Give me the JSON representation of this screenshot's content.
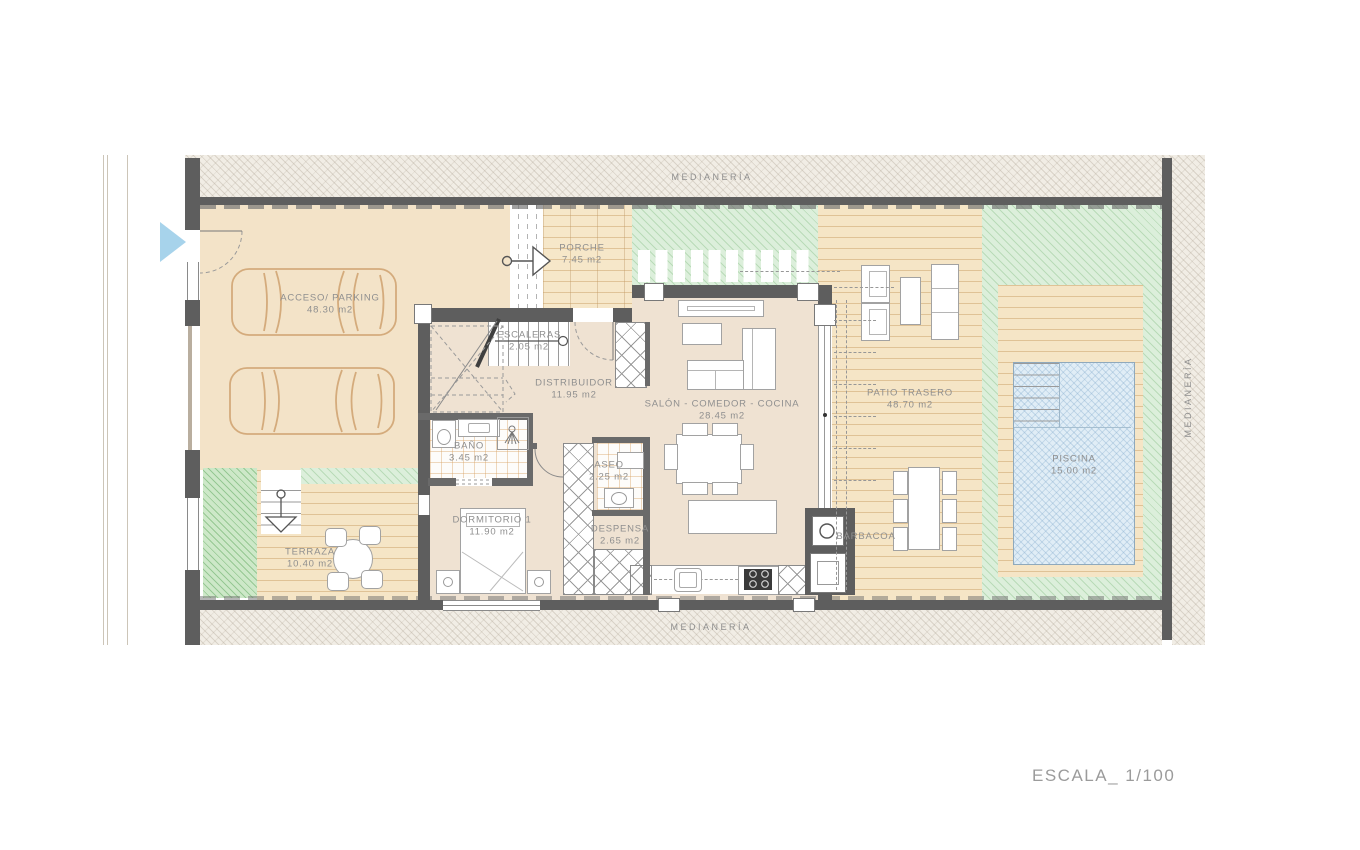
{
  "plan": {
    "scale_label": "ESCALA_ 1/100",
    "boundaries": {
      "top": "MEDIANERÍA",
      "bottom": "MEDIANERÍA",
      "right": "MEDIANERÍA"
    },
    "rooms": [
      {
        "name": "ACCESO/ PARKING",
        "area": "48.30 m2"
      },
      {
        "name": "PORCHE",
        "area": "7.45 m2"
      },
      {
        "name": "ESCALERAS",
        "area": "2.05 m2"
      },
      {
        "name": "DISTRIBUIDOR",
        "area": "11.95 m2"
      },
      {
        "name": "SALÓN - COMEDOR - COCINA",
        "area": "28.45 m2"
      },
      {
        "name": "BAÑO",
        "area": "3.45 m2"
      },
      {
        "name": "ASEO",
        "area": "2.25 m2"
      },
      {
        "name": "DORMITORIO 1",
        "area": "11.90 m2"
      },
      {
        "name": "DESPENSA",
        "area": "2.65 m2"
      },
      {
        "name": "TERRAZA",
        "area": "10.40 m2"
      },
      {
        "name": "PATIO TRASERO",
        "area": "48.70 m2"
      },
      {
        "name": "PISCINA",
        "area": "15.00 m2"
      },
      {
        "name": "BARBACOA",
        "area": ""
      }
    ],
    "colors": {
      "wall": "#5e5e5e",
      "interior_floor": "#efe2d2",
      "garage_floor": "#f3e3c8",
      "wood_deck": "#f5e5c6",
      "lawn": "#dcefdb",
      "pool_water": "#e0edf6",
      "label_text": "#8f8f8f",
      "nav_arrow_blue": "#a7d3eb",
      "car_outline": "#d4ab7c"
    }
  }
}
